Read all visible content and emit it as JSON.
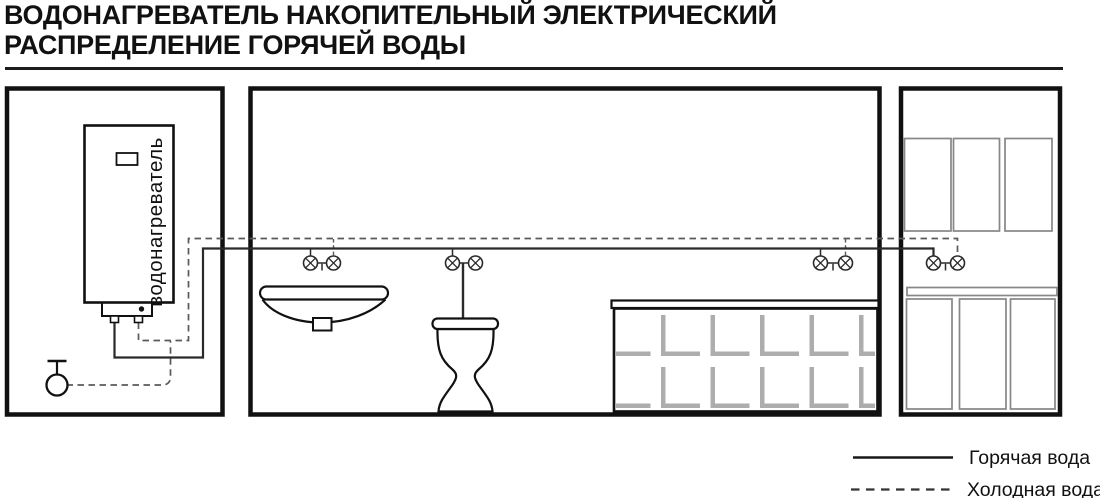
{
  "title": {
    "line1": "ВОДОНАГРЕВАТЕЛЬ НАКОПИТЕЛЬНЫЙ ЭЛЕКТРИЧЕСКИЙ",
    "line2": "РАСПРЕДЕЛЕНИЕ ГОРЯЧЕЙ ВОДЫ"
  },
  "heater": {
    "label": "водонагреватель"
  },
  "legend": {
    "hot": {
      "label": "Горячая вода",
      "line_style": "solid",
      "color": "#1a1a1a"
    },
    "cold": {
      "label": "Холодная вода",
      "line_style": "dashed",
      "color": "#333333"
    }
  },
  "fixtures": [
    "water-heater",
    "shutoff-valve",
    "washbasin-sink",
    "toilet",
    "bathtub",
    "kitchen-upper-cabinets",
    "kitchen-countertop",
    "kitchen-lower-cabinets",
    "faucet-valve-pairs"
  ],
  "colors": {
    "background": "#ffffff",
    "outline": "#111111",
    "hot_pipe": "#2a2a2a",
    "cold_pipe": "#5a5a5a",
    "tile": "#adadad",
    "cabinet": "#878787"
  }
}
